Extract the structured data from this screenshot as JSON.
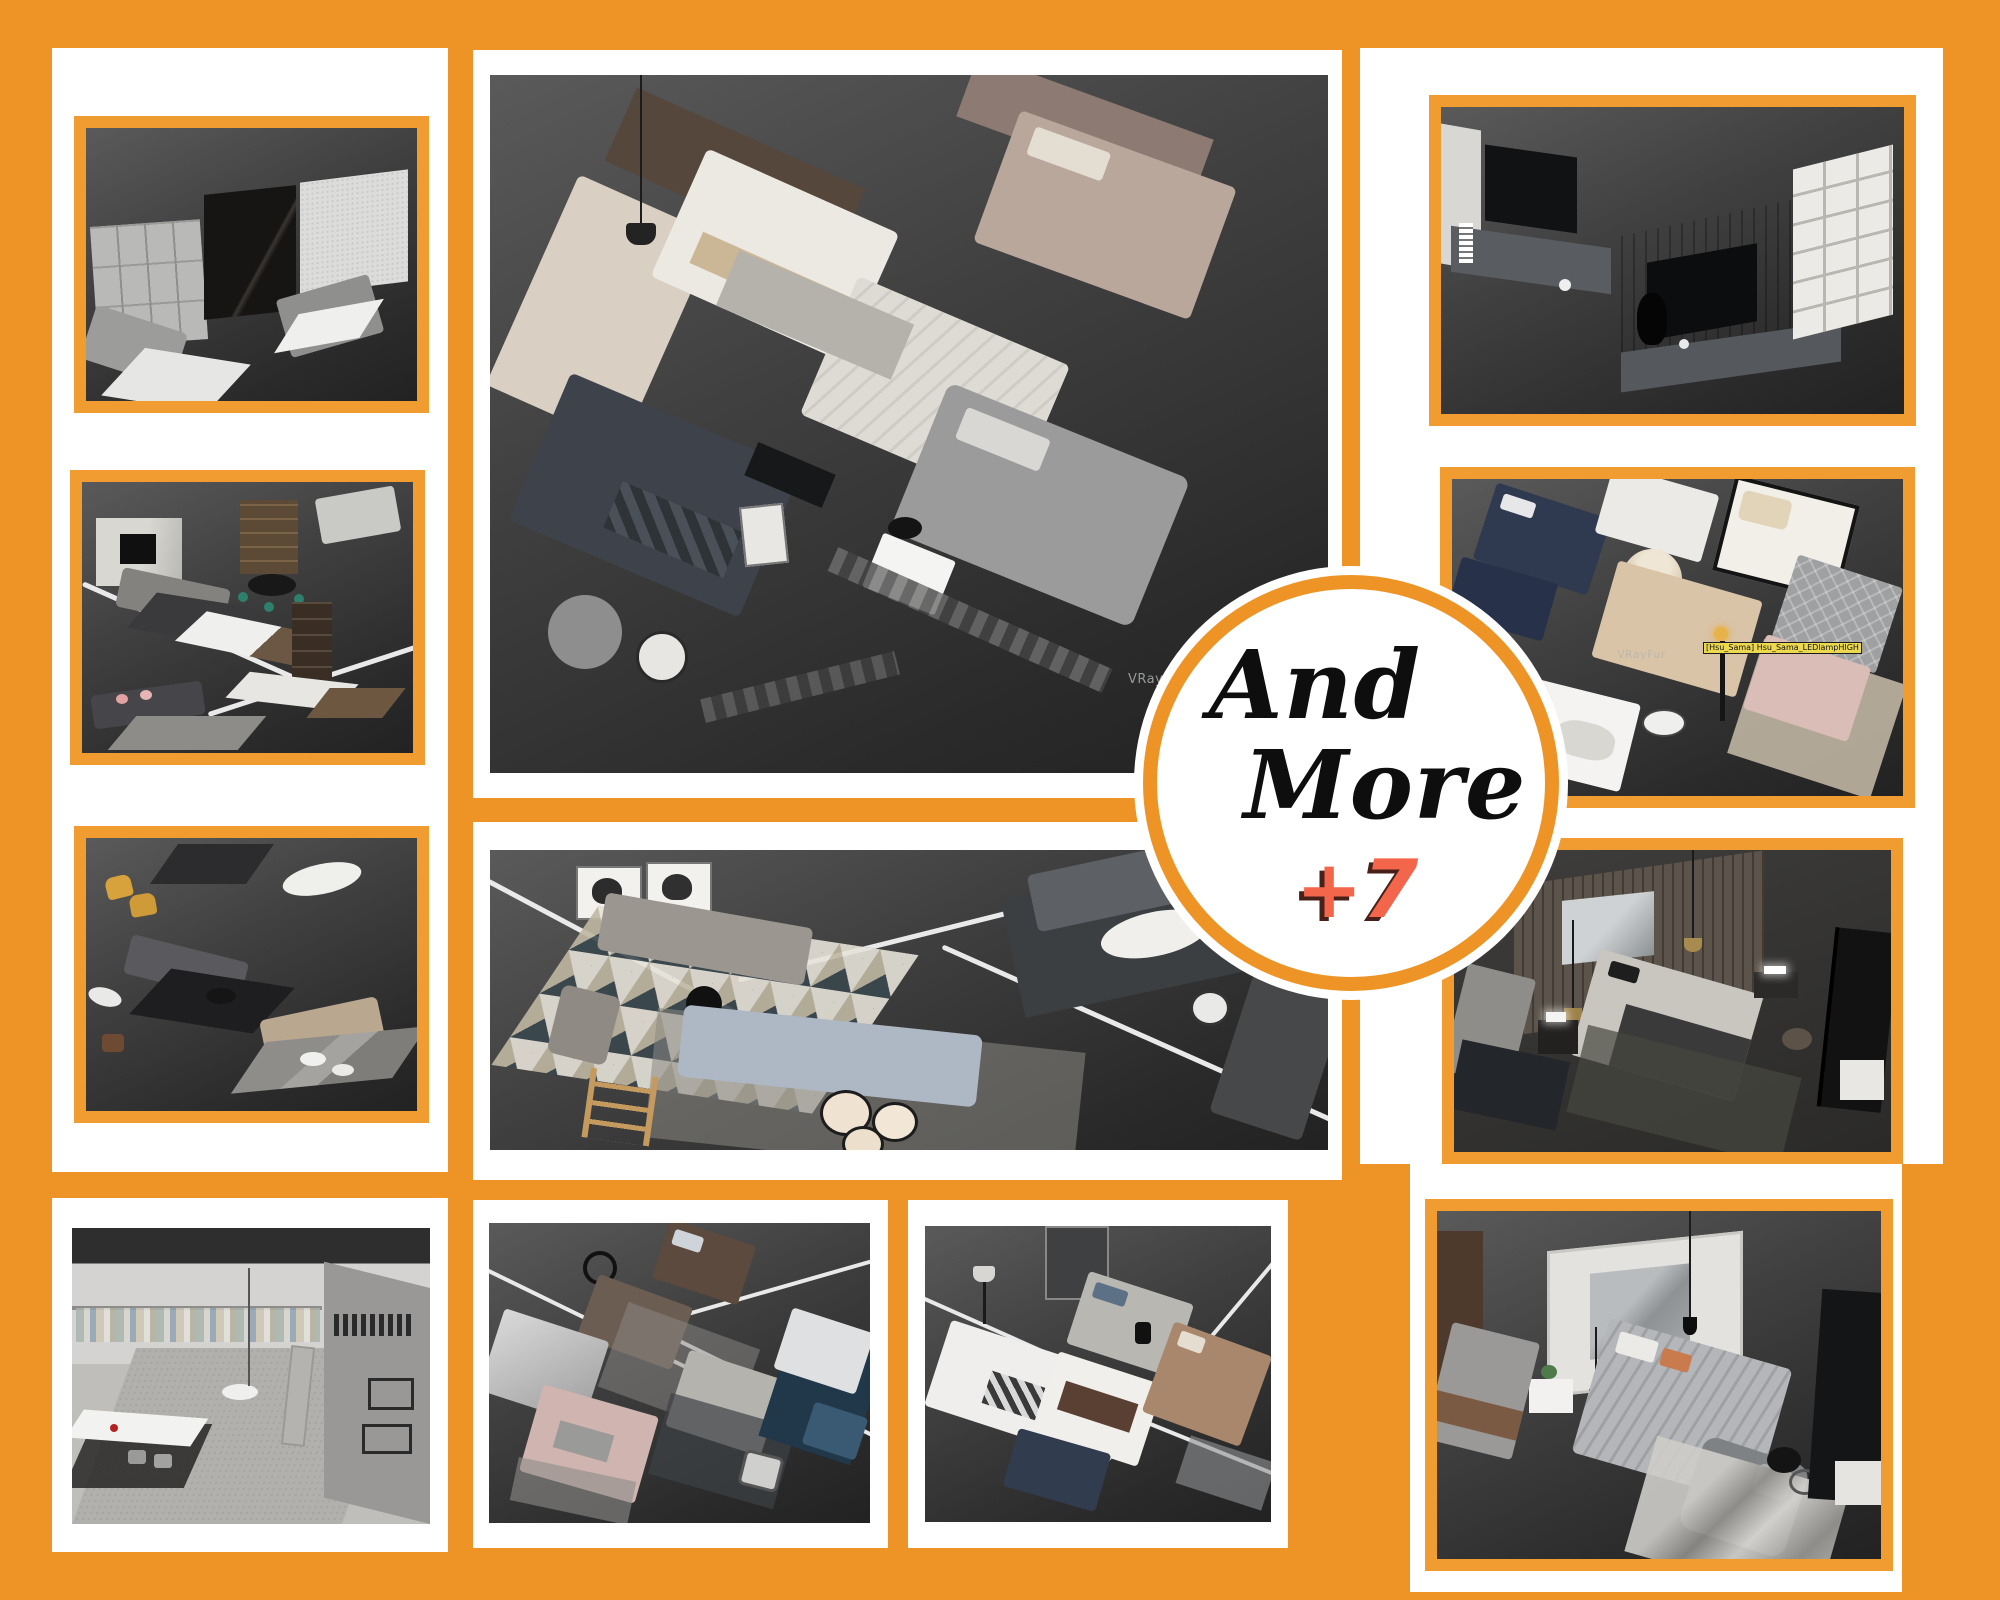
{
  "poster": {
    "background_color": "#EE9426",
    "panel_color": "#FFFFFF",
    "frame_color": "#F09C30",
    "kind": "furniture 3D-render collage poster"
  },
  "badge": {
    "line1": "And",
    "line2": "More",
    "counter": "+7",
    "ring_color": "#EE9426",
    "text_color": "#0E0E0E",
    "counter_color": "#F4664B"
  },
  "overlays": {
    "vray_watermark_main": "VRayFu",
    "vray_watermark_beds": "VRayFur",
    "tooltip_label": "[Hsu_Sama] Hsu_Sama_LEDlampHIGH",
    "tooltip_bg": "#EDD94F"
  },
  "images": {
    "left_top": {
      "label": "living-room-wall-finishes",
      "description": "Render: wardrobe fronts, black marble wall panel, white woven wall panel, gray sofa with white rug on dark background"
    },
    "left_middle": {
      "label": "living-dining-collection",
      "description": "Render: marble TV wall, kitchen island, tall bookshelf, dining sets with teal chairs, sofa with pink pillows, white zone divider lines"
    },
    "left_bottom": {
      "label": "sofa-dining-collection",
      "description": "Render: mustard armchairs, dark dining table, white oval table, gray sofa on black rug, beige sofa set on marble rug"
    },
    "bottom_left": {
      "label": "walk-in-closet",
      "description": "Light render: clothes hanging on rails, white island table with chairs, large gray carpet, second closet room with black garments"
    },
    "center_big": {
      "label": "bed-collection-large",
      "description": "Large render: many modern beds - cream bed, white striped bed, mauve tufted-headboard bed, dark plaid bed, gray wing bed, armchair with marble side table, checkered runner"
    },
    "center_middle": {
      "label": "living-rooms-top-view",
      "description": "Top view render: horse art prints, gray sofa on geometric diamond rug, pale blue sofa with round cream nesting tables, dark sectional with oval white table, white divider lines"
    },
    "bottom_center_left": {
      "label": "bed-collection-one",
      "description": "Render: silver satin bed, blush pink bed, dark brown bed, gray bed, beds on navy rug, round mirror, white divider lines"
    },
    "bottom_center_right": {
      "label": "bed-collection-two",
      "description": "Render: white bed with checkered throw, brown-white bed, navy bed, tan bed with black lamps, gray bed with art, floor lamp, white divider lines"
    },
    "right_top": {
      "label": "tv-wall-units",
      "description": "Render: white TV wall with gray cabinet, walnut TV panel with black TV, white bookshelf columns with books, black vase lamp"
    },
    "right_middle": {
      "label": "bedroom-collection",
      "description": "Render: navy beds, four-poster bed, cream fan-headboard bed, gray tufted bed, blush bed on beige rug with glowing floor lamp and yellow object tooltip, white fur bed"
    },
    "right_lower": {
      "label": "dark-bedroom-scene",
      "description": "Dark render: wood slat wall with brass pendant lights, gray art print, bed with light linens and charcoal duvet, floating nightstands, leaning black art panel"
    },
    "bottom_right": {
      "label": "gray-bedroom-scene",
      "description": "Render: white paneled art wall, gray bed with ribbed duvet, pendant bulbs, lounge chair, marble-texture rug, tall wood wardrobe, leaning black panel"
    }
  }
}
